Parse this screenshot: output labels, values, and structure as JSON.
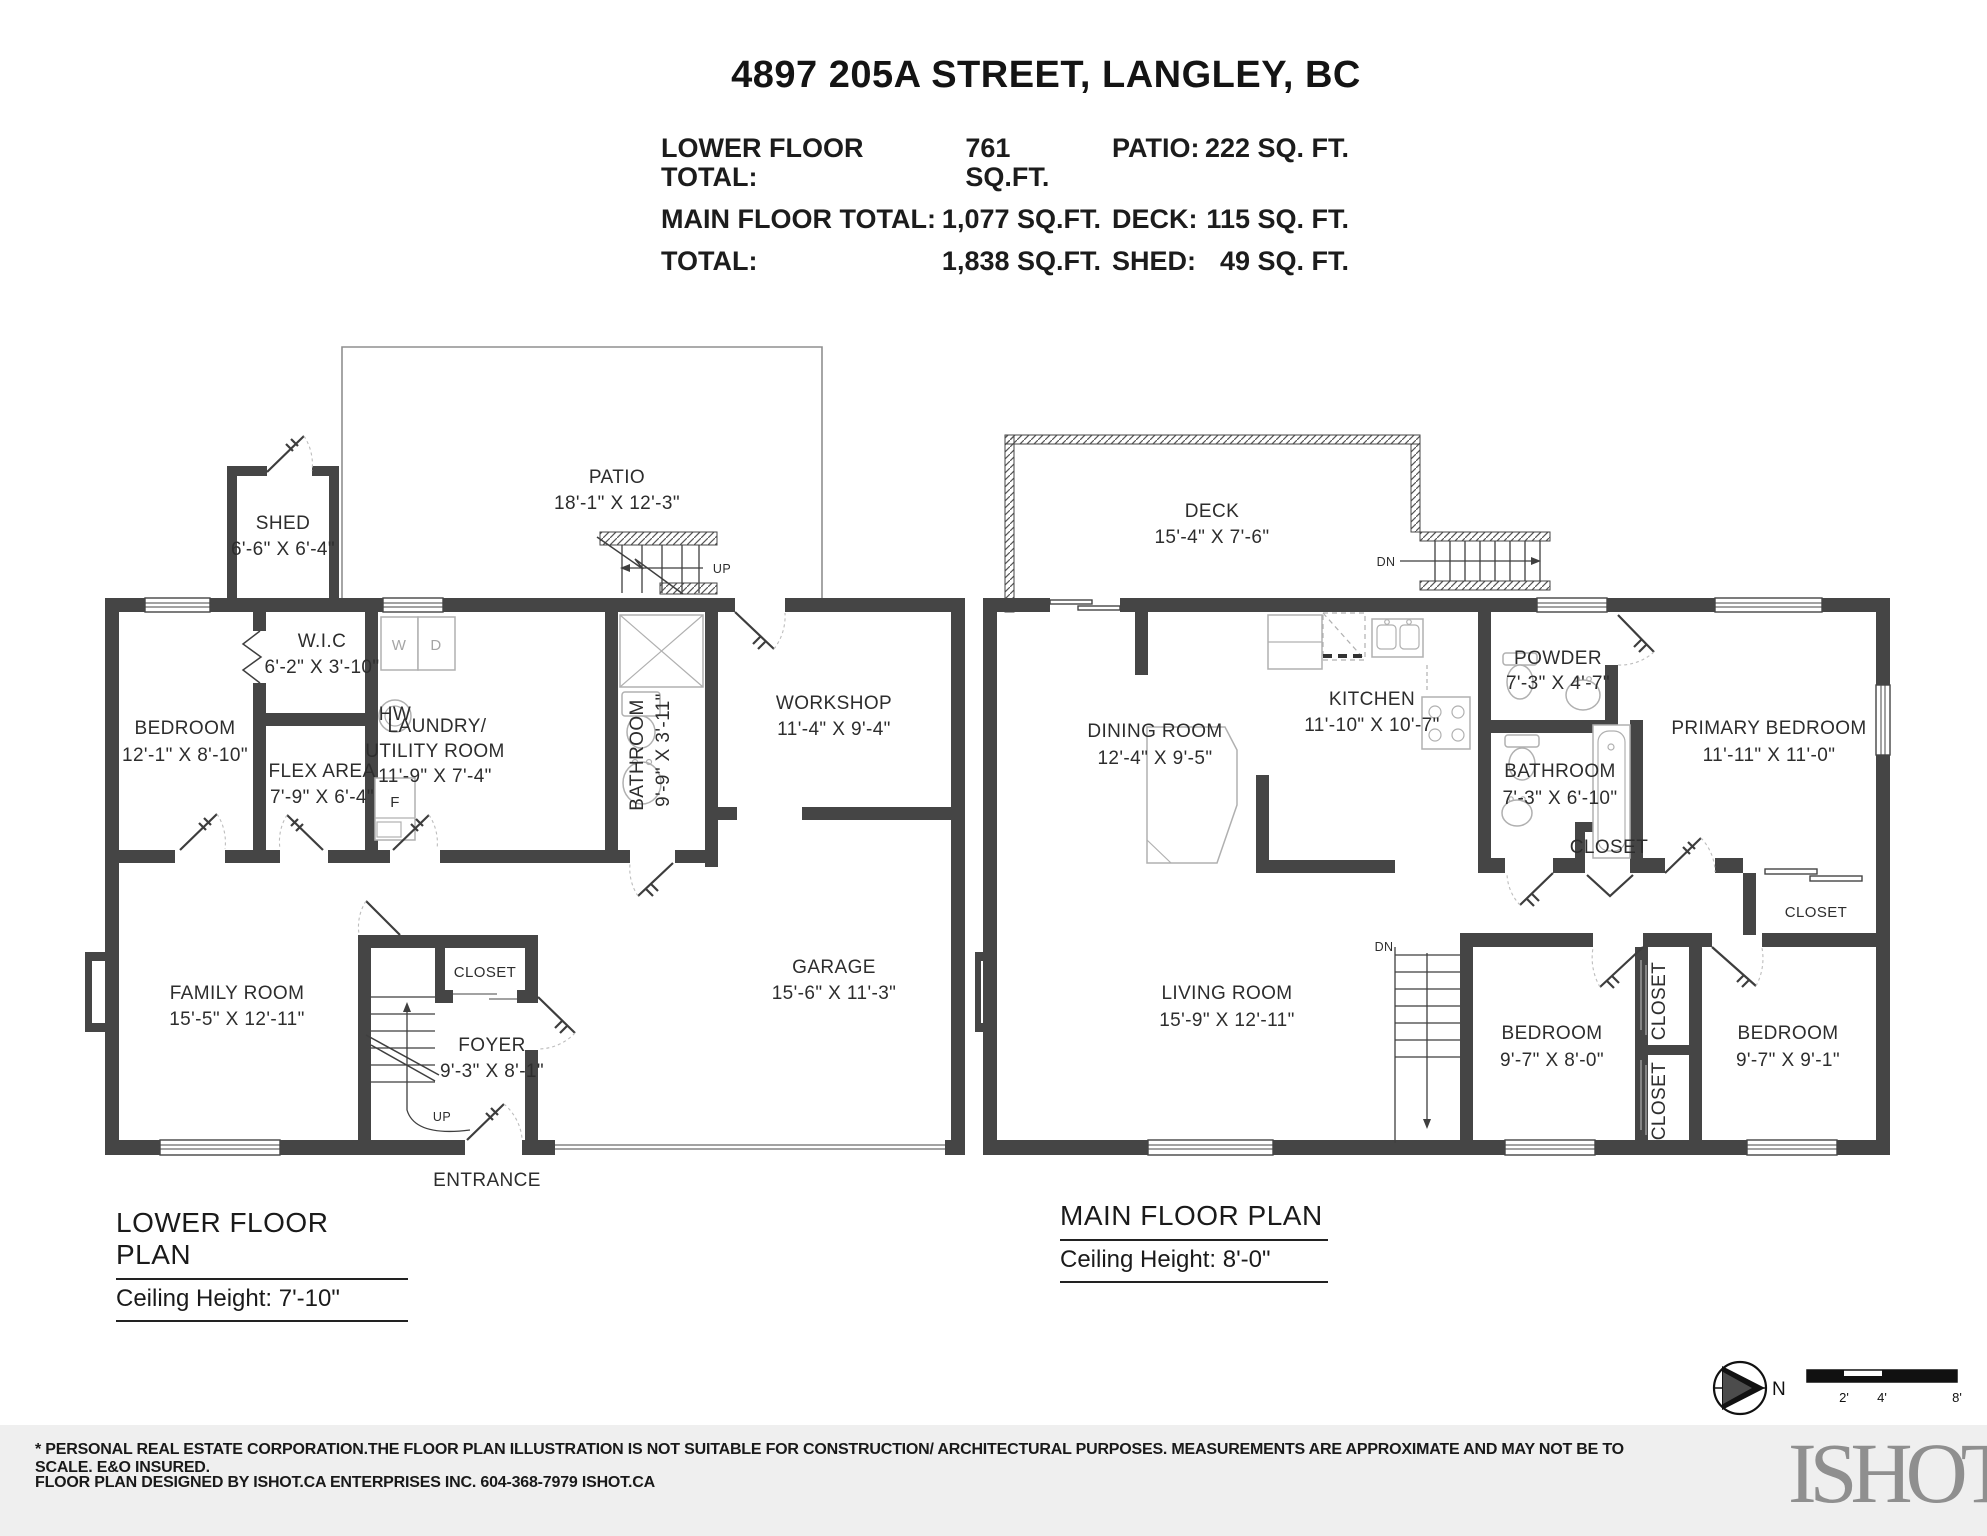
{
  "header": {
    "title": "4897 205A STREET, LANGLEY, BC",
    "rows": [
      {
        "label": "LOWER FLOOR TOTAL:",
        "value": "761 SQ.FT.",
        "label2": "PATIO:",
        "value2": "222 SQ. FT."
      },
      {
        "label": "MAIN FLOOR TOTAL:",
        "value": "1,077 SQ.FT.",
        "label2": "DECK:",
        "value2": "115 SQ. FT."
      },
      {
        "label": "TOTAL:",
        "value": "1,838 SQ.FT.",
        "label2": "SHED:",
        "value2": "49 SQ. FT."
      }
    ]
  },
  "lower": {
    "plan_title": "LOWER FLOOR PLAN",
    "ceiling": "Ceiling Height: 7'-10\"",
    "rooms": {
      "patio": {
        "name": "PATIO",
        "dims": "18'-1\" X 12'-3\""
      },
      "shed": {
        "name": "SHED",
        "dims": "6'-6\" X 6'-4\""
      },
      "wic": {
        "name": "W.I.C",
        "dims": "6'-2\" X 3'-10\""
      },
      "bedroom": {
        "name": "BEDROOM",
        "dims": "12'-1\" X 8'-10\""
      },
      "flex": {
        "name": "FLEX AREA",
        "dims": "7'-9\" X 6'-4\""
      },
      "laundry": {
        "name1": "LAUNDRY/",
        "name2": "UTILITY ROOM",
        "dims": "11'-9\" X 7'-4\""
      },
      "bathroom": {
        "name": "BATHROOM",
        "dims": "9'-9\" X 3'-11\""
      },
      "workshop": {
        "name": "WORKSHOP",
        "dims": "11'-4\" X 9'-4\""
      },
      "family": {
        "name": "FAMILY ROOM",
        "dims": "15'-5\" X 12'-11\""
      },
      "closet": {
        "name": "CLOSET"
      },
      "foyer": {
        "name": "FOYER",
        "dims": "9'-3\" X 8'-1\""
      },
      "garage": {
        "name": "GARAGE",
        "dims": "15'-6\" X 11'-3\""
      }
    },
    "markers": {
      "up_patio": "UP",
      "up_stairs": "UP",
      "entrance": "ENTRANCE",
      "washer": "W",
      "dryer": "D",
      "freezer": "F",
      "hot_water": "HW"
    }
  },
  "main": {
    "plan_title": "MAIN FLOOR PLAN",
    "ceiling": "Ceiling Height: 8'-0\"",
    "rooms": {
      "deck": {
        "name": "DECK",
        "dims": "15'-4\" X 7'-6\""
      },
      "kitchen": {
        "name": "KITCHEN",
        "dims": "11'-10\" X 10'-7\""
      },
      "dining": {
        "name": "DINING ROOM",
        "dims": "12'-4\" X 9'-5\""
      },
      "powder": {
        "name": "POWDER",
        "dims": "7'-3\" X 4'-7\""
      },
      "bathroom": {
        "name": "BATHROOM",
        "dims": "7'-3\" X 6'-10\""
      },
      "primary": {
        "name": "PRIMARY BEDROOM",
        "dims": "11'-11\" X 11'-0\""
      },
      "living": {
        "name": "LIVING ROOM",
        "dims": "15'-9\" X 12'-11\""
      },
      "bedroom1": {
        "name": "BEDROOM",
        "dims": "9'-7\" X 8'-0\""
      },
      "bedroom2": {
        "name": "BEDROOM",
        "dims": "9'-7\" X 9'-1\""
      },
      "closet_hall": {
        "name": "CLOSET"
      },
      "closet_primary": {
        "name": "CLOSET"
      },
      "closet_v1": {
        "name": "CLOSET"
      },
      "closet_v2": {
        "name": "CLOSET"
      }
    },
    "markers": {
      "dn_deck": "DN",
      "dn_stairs": "DN"
    }
  },
  "compass": {
    "north": "N"
  },
  "scale_bar": {
    "ticks": [
      "2'",
      "4'",
      "8'"
    ]
  },
  "footer": {
    "line1": "* PERSONAL REAL ESTATE CORPORATION.THE FLOOR PLAN ILLUSTRATION IS NOT SUITABLE FOR CONSTRUCTION/ ARCHITECTURAL PURPOSES. MEASUREMENTS ARE APPROXIMATE AND MAY NOT BE TO SCALE. E&O INSURED.",
    "line2": "FLOOR PLAN DESIGNED BY ISHOT.CA ENTERPRISES INC. 604-368-7979  ISHOT.CA",
    "logo": "ISHOT"
  },
  "colors": {
    "wall": "#454545",
    "footer_bg": "#efefef",
    "fixture": "#b0b0b0"
  }
}
